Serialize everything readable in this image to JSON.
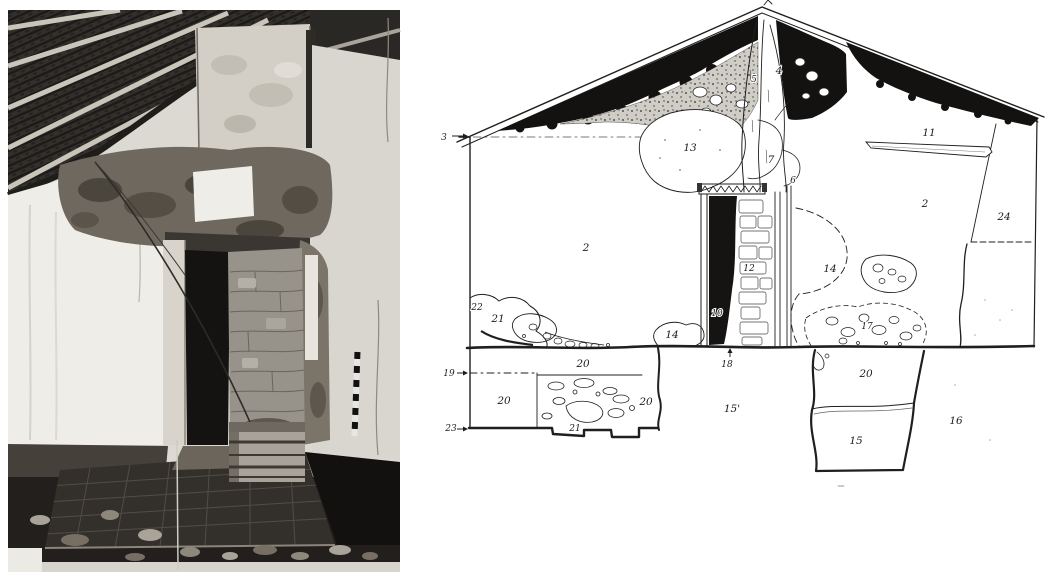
{
  "page": {
    "background": "#ffffff"
  },
  "figure": {
    "left_panel": {
      "kind": "photograph",
      "description": "Black-and-white interior photograph: exposed timber roof rafters above, ruined earthen wall with plaster loss, a doorway partly blocked by a rough stone pier, tiled floor with rubble, a wooden crate and a striped survey rod",
      "palette": {
        "roof_dark": "#2b2926",
        "rafter_light": "#c9c5bb",
        "wall_white": "#efede7",
        "wall_gray": "#d9d6cf",
        "mud": "#6e685f",
        "door_shadow": "#161412",
        "pier_stone": "#98938a",
        "floor_tile": "#33302b",
        "rubble_dark": "#221f1c"
      }
    },
    "right_panel": {
      "kind": "hand-drawn stratigraphic elevation of gable wall",
      "ink_color": "#1f1f1f",
      "labels": [
        {
          "text": "3",
          "x": 444,
          "y": 140,
          "small": true
        },
        {
          "text": "13",
          "x": 690,
          "y": 151
        },
        {
          "text": "5",
          "x": 754,
          "y": 82,
          "small": true
        },
        {
          "text": "4",
          "x": 779,
          "y": 74
        },
        {
          "text": "7",
          "x": 771,
          "y": 163
        },
        {
          "text": "6",
          "x": 793,
          "y": 183,
          "small": true
        },
        {
          "text": "11",
          "x": 929,
          "y": 136
        },
        {
          "text": "2",
          "x": 586,
          "y": 251
        },
        {
          "text": "2",
          "x": 925,
          "y": 207
        },
        {
          "text": "24",
          "x": 1004,
          "y": 220
        },
        {
          "text": "14",
          "x": 830,
          "y": 272
        },
        {
          "text": "12",
          "x": 749,
          "y": 271,
          "small": true
        },
        {
          "text": "10",
          "x": 717,
          "y": 316,
          "small": true
        },
        {
          "text": "22",
          "x": 477,
          "y": 310,
          "small": true
        },
        {
          "text": "21",
          "x": 498,
          "y": 322
        },
        {
          "text": "14",
          "x": 672,
          "y": 338
        },
        {
          "text": "17",
          "x": 867,
          "y": 329,
          "small": true
        },
        {
          "text": "18",
          "x": 727,
          "y": 367,
          "small": true
        },
        {
          "text": "19",
          "x": 449,
          "y": 376,
          "small": true
        },
        {
          "text": "20",
          "x": 583,
          "y": 367
        },
        {
          "text": "20",
          "x": 504,
          "y": 404
        },
        {
          "text": "20",
          "x": 646,
          "y": 405
        },
        {
          "text": "21",
          "x": 575,
          "y": 431,
          "small": true
        },
        {
          "text": "23",
          "x": 451,
          "y": 431,
          "small": true
        },
        {
          "text": "15'",
          "x": 732,
          "y": 412
        },
        {
          "text": "20",
          "x": 866,
          "y": 377
        },
        {
          "text": "15",
          "x": 856,
          "y": 444
        },
        {
          "text": "16",
          "x": 956,
          "y": 424
        }
      ]
    }
  }
}
